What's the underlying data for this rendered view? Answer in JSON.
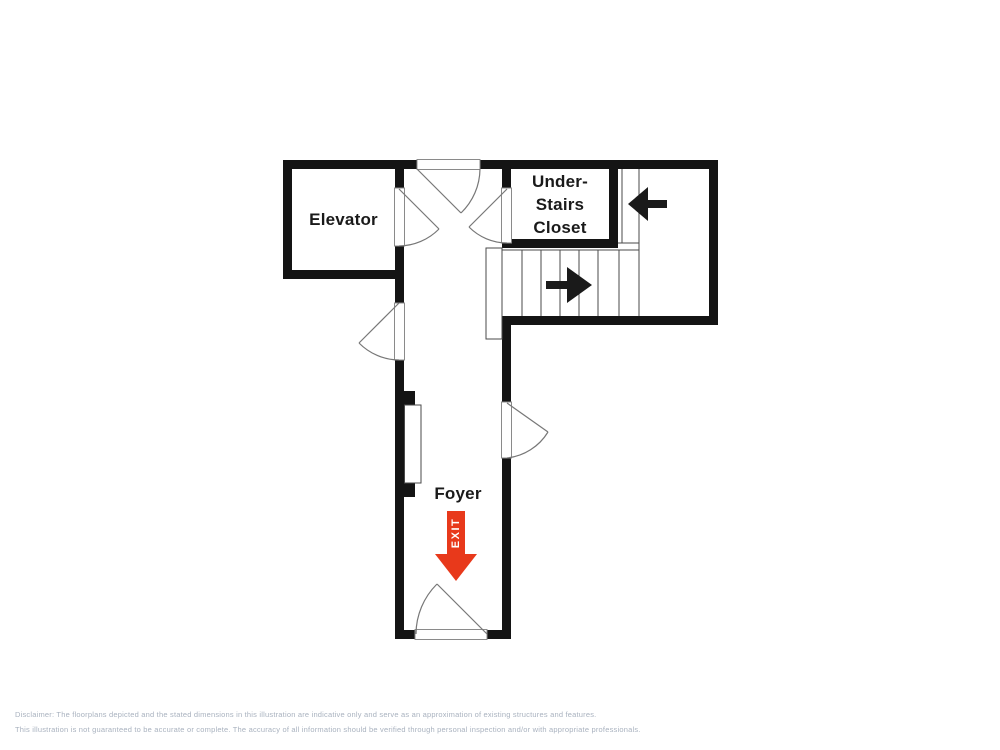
{
  "plan": {
    "rooms": {
      "elevator": {
        "label": "Elevator"
      },
      "understairs_closet": {
        "line1": "Under-",
        "line2": "Stairs",
        "line3": "Closet"
      },
      "foyer": {
        "label": "Foyer"
      }
    },
    "exit": {
      "label": "EXIT",
      "color": "#e8391b"
    },
    "colors": {
      "wall": "#141414",
      "thin_line": "#4a4a4a",
      "door_line": "#777777",
      "arrow": "#1a1a1a",
      "background": "#ffffff"
    }
  },
  "disclaimer": {
    "line1": "Disclaimer: The floorplans depicted and the stated dimensions in this illustration are indicative only and serve as an approximation of existing structures and features.",
    "line2": "This illustration is not guaranteed to be accurate or complete. The accuracy of all information should be verified through personal inspection and/or with appropriate professionals."
  }
}
